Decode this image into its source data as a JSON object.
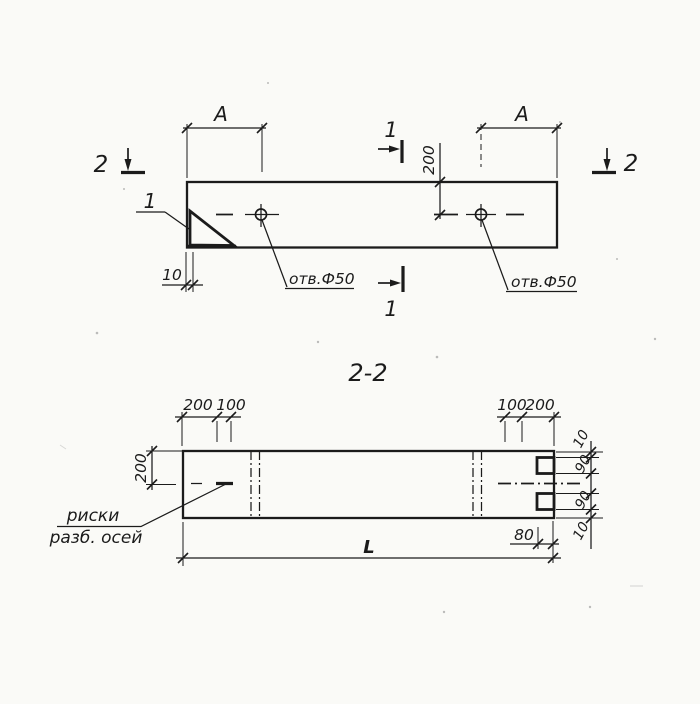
{
  "colors": {
    "ink": "#1b1b1b",
    "paper": "#fafaf7"
  },
  "plan": {
    "dim_a": "A",
    "dim_200": "200",
    "dim_10": "10",
    "hole_label": "отв.Ф50",
    "cut_mark_1": "1",
    "cut_mark_2": "2",
    "detail_ref": "1"
  },
  "section": {
    "title": "2-2",
    "dims_top_left": [
      "200",
      "100"
    ],
    "dims_top_right": [
      "100",
      "200"
    ],
    "dim_depth": "200",
    "dims_right": [
      "10",
      "90",
      "90",
      "10"
    ],
    "dim_80": "80",
    "dim_length": "L",
    "note_line1": "риски",
    "note_line2": "разб. осей"
  }
}
